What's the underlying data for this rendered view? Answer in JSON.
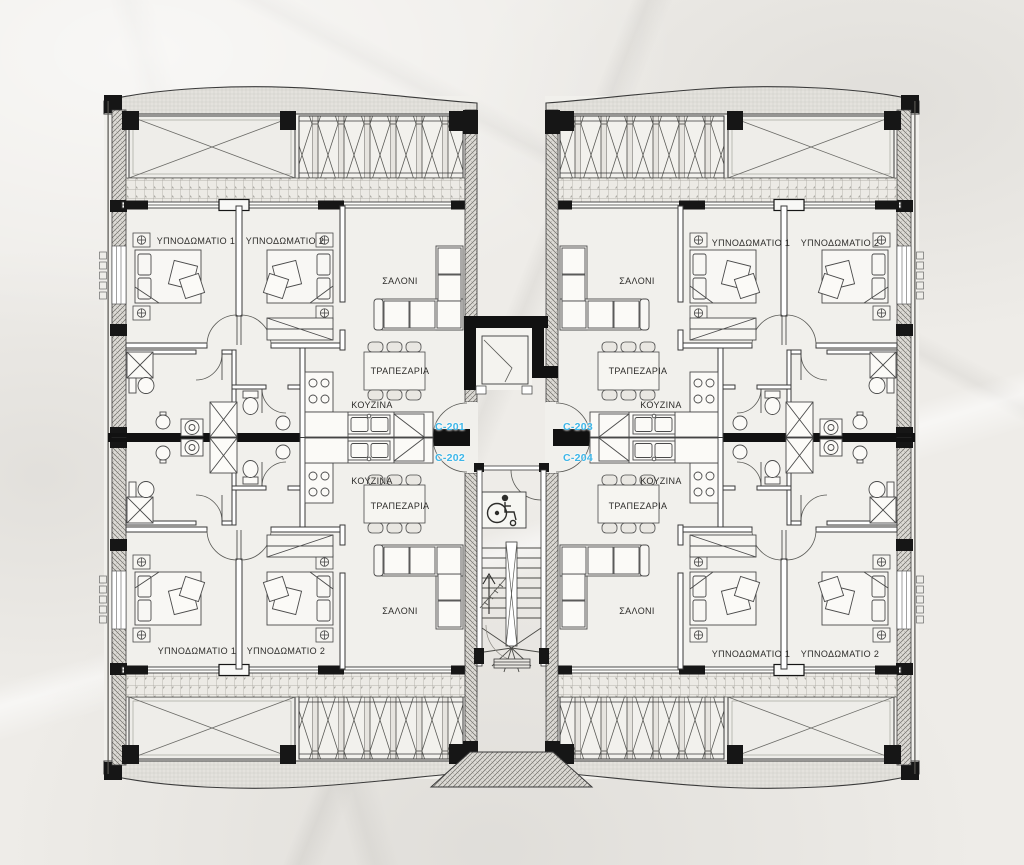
{
  "plan": {
    "units": {
      "c201": "C-201",
      "c202": "C-202",
      "c203": "C-203",
      "c204": "C-204"
    },
    "room_labels": {
      "bedroom1": "ΥΠΝΟΔΩΜΑΤΙΟ 1",
      "bedroom2": "ΥΠΝΟΔΩΜΑΤΙΟ 2",
      "living": "ΣΑΛΟΝΙ",
      "dining": "ΤΡΑΠΕΖΑΡΙΑ",
      "kitchen": "ΚΟΥΖΙΝΑ"
    },
    "colors": {
      "unit_label": "#3db6e8",
      "linework": "#3a3a3a",
      "wall_fill": "#141414",
      "paper": "#eeece8"
    }
  }
}
